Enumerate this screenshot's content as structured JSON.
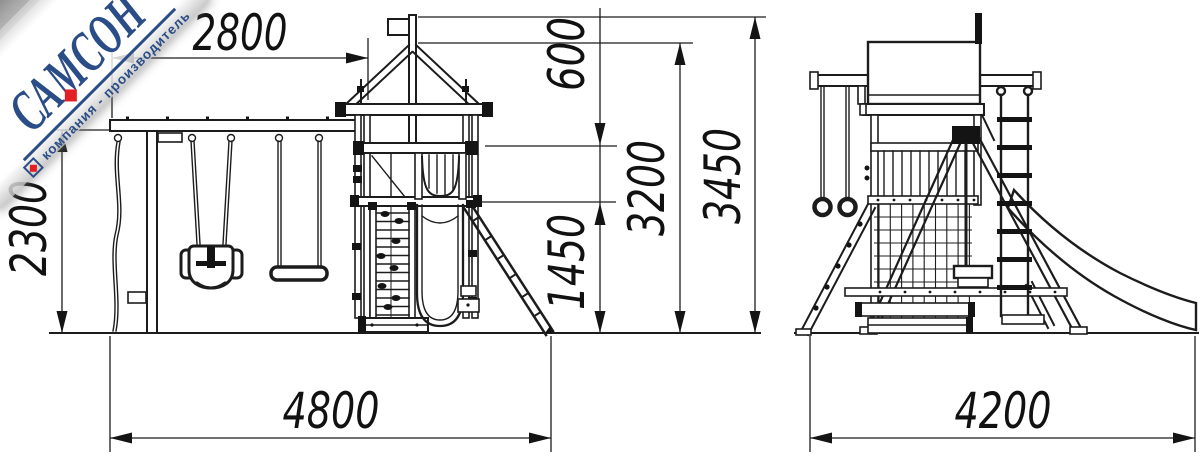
{
  "watermark": {
    "brand": "САМСОН",
    "tagline": "компания - производитель",
    "brand_color": "#2b4d87",
    "accent_color": "#e31e24"
  },
  "drawing": {
    "background": "#ffffff",
    "line_color": "#1c1c1c",
    "dimensions_mm": {
      "beam_span": "2800",
      "swing_frame_height": "2300",
      "rail_to_floor": "600",
      "apex_height": "3200",
      "total_height": "3450",
      "platform_height": "1450",
      "front_overall_width": "4800",
      "side_overall_width": "4200"
    }
  }
}
